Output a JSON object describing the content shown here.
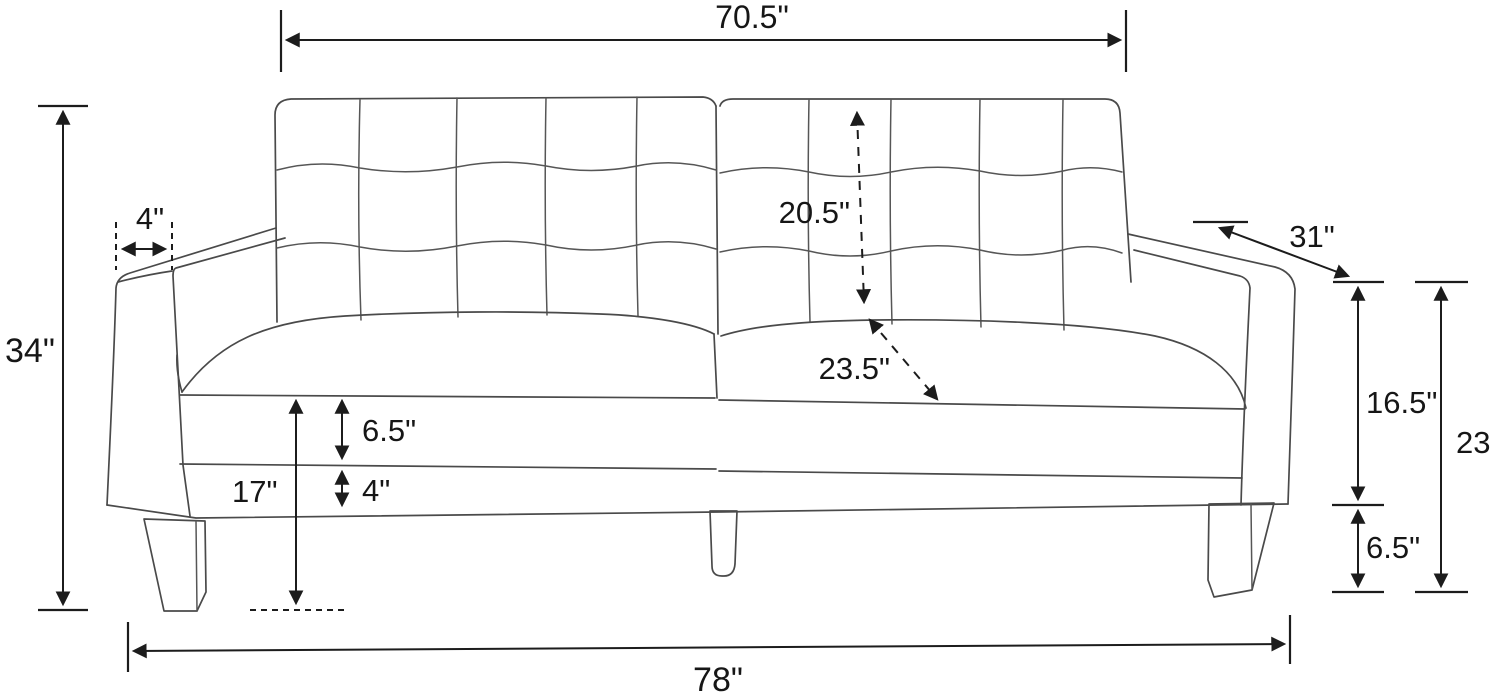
{
  "diagram": {
    "kind": "furniture-dimension-line-drawing",
    "subject": "tufted two-cushion sofa, three-quarter view",
    "unit": "inches",
    "line_color": "#4a4a4a",
    "dimension_color": "#1c1c1c",
    "background": "#ffffff"
  },
  "dims": {
    "back_width": {
      "label": "70.5\"",
      "position": "top"
    },
    "overall_height": {
      "label": "34\"",
      "position": "left"
    },
    "arm_width": {
      "label": "4\"",
      "position": "top-left-arm"
    },
    "back_height": {
      "label": "20.5\"",
      "position": "backrest-dashed"
    },
    "seat_depth": {
      "label": "23.5\"",
      "position": "seat-dashed-diagonal"
    },
    "overall_depth": {
      "label": "31\"",
      "position": "top-right-diagonal"
    },
    "arm_to_base": {
      "label": "16.5\"",
      "position": "right-upper"
    },
    "leg_height": {
      "label": "6.5\"",
      "position": "right-lower"
    },
    "arm_height": {
      "label": "23\"",
      "position": "far-right"
    },
    "cushion_thickness": {
      "label": "6.5\"",
      "position": "left-seat-band"
    },
    "frame_height": {
      "label": "4\"",
      "position": "left-frame-band"
    },
    "seat_height": {
      "label": "17\"",
      "position": "left-to-floor"
    },
    "overall_width": {
      "label": "78\"",
      "position": "bottom"
    }
  }
}
